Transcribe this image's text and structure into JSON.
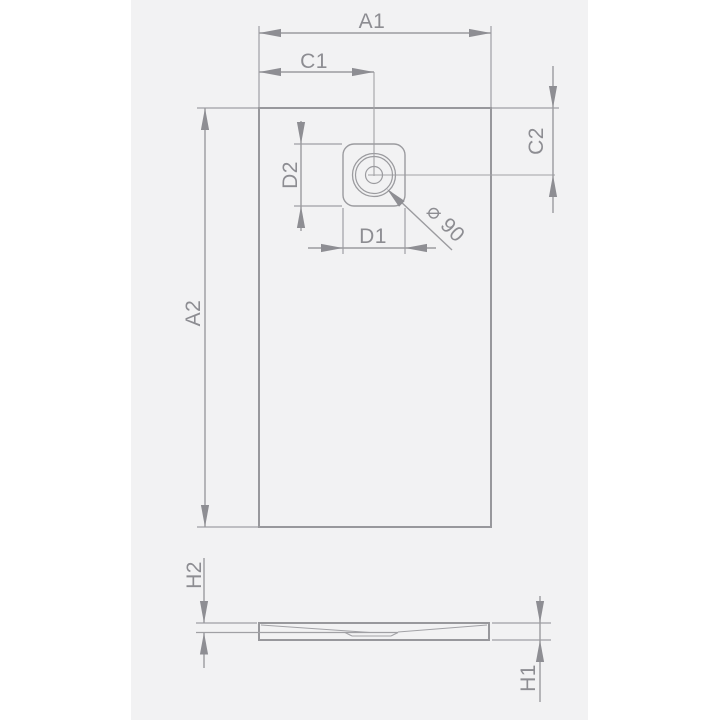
{
  "diagram": {
    "labels": {
      "a1": "A1",
      "c1": "C1",
      "c2": "C2",
      "a2": "A2",
      "d2": "D2",
      "d1": "D1",
      "h2": "H2",
      "h1": "H1",
      "diameter": "⌀ 90"
    },
    "drain": {
      "diameter_value": 90
    },
    "colors": {
      "canvas": "#f2f2f3",
      "page": "#ffffff",
      "line": "#9b9b9f",
      "text": "#8d8d92"
    }
  }
}
